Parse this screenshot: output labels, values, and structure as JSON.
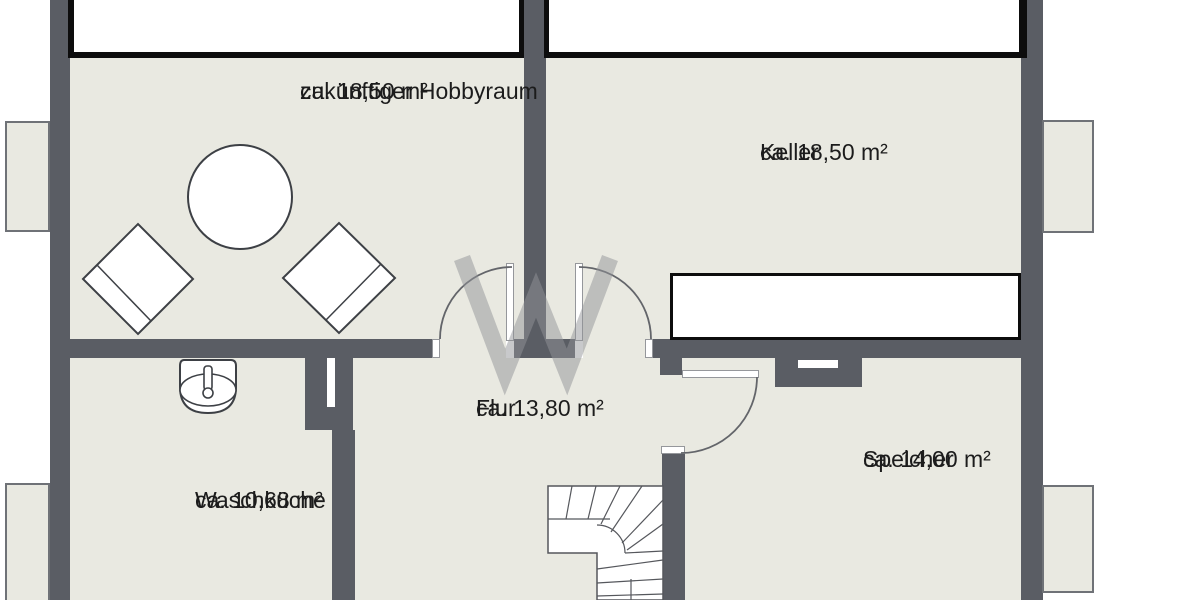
{
  "plan": {
    "rooms": [
      {
        "id": "hobbyraum",
        "name": "zukünftiger Hobbyraum",
        "area": "ca. 18,50 m²"
      },
      {
        "id": "keller",
        "name": "Keller",
        "area": "ca. 18,50 m²"
      },
      {
        "id": "flur",
        "name": "Flur",
        "area": "ca. 13,80 m²"
      },
      {
        "id": "waschkueche",
        "name": "Waschküche",
        "area": "ca. 10,68 m²"
      },
      {
        "id": "speicher",
        "name": "Speicher",
        "area": "ca. 14,00 m²"
      }
    ],
    "furniture": [
      "round-table",
      "chair",
      "chair",
      "washbasin",
      "workbench",
      "winder-staircase",
      "chimney"
    ],
    "symbols": [
      "door-swing-arc",
      "window-bay",
      "light-well"
    ],
    "colors": {
      "wall": "#5a5d64",
      "room_fill": "#e9e9e1",
      "outline": "#3d4045",
      "arc": "#63656a",
      "window_line": "#0d0d0d",
      "text": "#1c1c1c",
      "background": "#ffffff",
      "bump_border": "#6f7277",
      "watermark": "rgba(145,147,152,0.5)"
    }
  }
}
